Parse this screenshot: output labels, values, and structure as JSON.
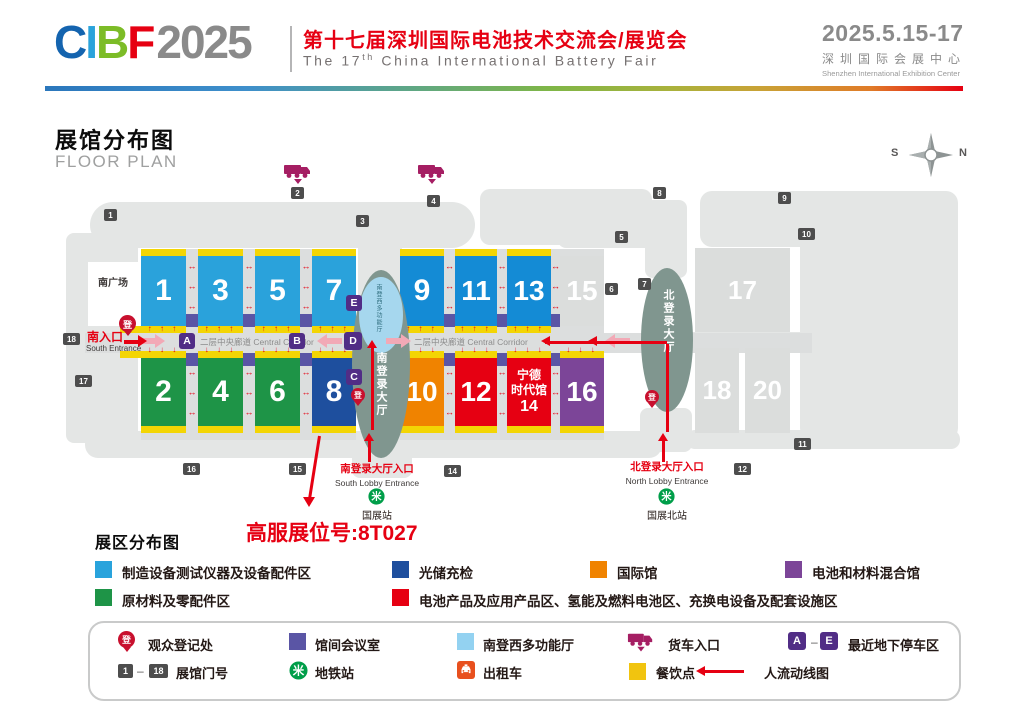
{
  "header": {
    "logo_letters": [
      {
        "ch": "C",
        "color": "#1464AF"
      },
      {
        "ch": "I",
        "color": "#2AA3DB"
      },
      {
        "ch": "B",
        "color": "#7CBC27"
      },
      {
        "ch": "F",
        "color": "#E60012"
      }
    ],
    "logo_year": "2025",
    "title_cn": "第十七届深圳国际电池技术交流会/展览会",
    "title_en_pre": "The 17",
    "title_en_sup": "th",
    "title_en_post": " China International Battery Fair",
    "date": "2025.5.15-17",
    "venue_cn": "深圳国际会展中心",
    "venue_en": "Shenzhen International Exhibition Center"
  },
  "plan": {
    "title_cn": "展馆分布图",
    "title_en": "FLOOR PLAN",
    "compass": {
      "west_label": "S",
      "east_label": "N"
    },
    "south_plaza": "南广场",
    "south_entrance_cn": "南入口",
    "south_entrance_en": "South Entrance",
    "corridor_label": "二层中央廊道 Central Corridor",
    "multifunction_vertical": "南登西多功能厅",
    "south_lobby_vertical": "南登录大厅",
    "north_lobby_vertical": "北登录大厅",
    "south_lobby_entrance_cn": "南登录大厅入口",
    "south_lobby_entrance_en": "South Lobby Entrance",
    "north_lobby_entrance_cn": "北登录大厅入口",
    "north_lobby_entrance_en": "North Lobby Entrance",
    "metro_south": "国展站",
    "metro_north": "国展北站",
    "metro_glyph": "米",
    "reg_glyph": "登",
    "booth_callout": "高服展位号:8T027",
    "halls": [
      {
        "n": "1",
        "x": 141,
        "y": 256,
        "w": 45,
        "h": 70,
        "c": "#2AA2DB",
        "s": true,
        "fs": 30
      },
      {
        "n": "3",
        "x": 198,
        "y": 256,
        "w": 45,
        "h": 70,
        "c": "#2AA2DB",
        "s": true,
        "fs": 30
      },
      {
        "n": "5",
        "x": 255,
        "y": 256,
        "w": 45,
        "h": 70,
        "c": "#2AA2DB",
        "s": true,
        "fs": 30
      },
      {
        "n": "7",
        "x": 312,
        "y": 256,
        "w": 44,
        "h": 70,
        "c": "#2AA2DB",
        "s": true,
        "fs": 30
      },
      {
        "n": "9",
        "x": 400,
        "y": 256,
        "w": 44,
        "h": 70,
        "c": "#148BD5",
        "s": true,
        "fs": 30
      },
      {
        "n": "11",
        "x": 455,
        "y": 256,
        "w": 42,
        "h": 70,
        "c": "#148BD5",
        "s": true,
        "fs": 28
      },
      {
        "n": "13",
        "x": 507,
        "y": 256,
        "w": 44,
        "h": 70,
        "c": "#148BD5",
        "s": true,
        "fs": 28
      },
      {
        "n": "15",
        "x": 560,
        "y": 256,
        "w": 44,
        "h": 70,
        "c": "#DBDDDC",
        "s": false,
        "fs": 28
      },
      {
        "n": "2",
        "x": 141,
        "y": 358,
        "w": 45,
        "h": 68,
        "c": "#1E9447",
        "s": true,
        "fs": 30
      },
      {
        "n": "4",
        "x": 198,
        "y": 358,
        "w": 45,
        "h": 68,
        "c": "#1E9447",
        "s": true,
        "fs": 30
      },
      {
        "n": "6",
        "x": 255,
        "y": 358,
        "w": 45,
        "h": 68,
        "c": "#1E9447",
        "s": true,
        "fs": 30
      },
      {
        "n": "8",
        "x": 312,
        "y": 358,
        "w": 44,
        "h": 68,
        "c": "#1E4F9E",
        "s": true,
        "fs": 30
      },
      {
        "n": "10",
        "x": 400,
        "y": 358,
        "w": 44,
        "h": 68,
        "c": "#F08300",
        "s": true,
        "fs": 28
      },
      {
        "n": "12",
        "x": 455,
        "y": 358,
        "w": 42,
        "h": 68,
        "c": "#E60012",
        "s": true,
        "fs": 28
      },
      {
        "n": "14",
        "x": 507,
        "y": 358,
        "w": 44,
        "h": 68,
        "c": "#E60012",
        "s": true,
        "fs": 15,
        "lines": [
          "宁德",
          "时代馆",
          "14"
        ]
      },
      {
        "n": "16",
        "x": 560,
        "y": 358,
        "w": 44,
        "h": 68,
        "c": "#7C4598",
        "s": true,
        "fs": 28
      },
      {
        "n": "17",
        "x": 695,
        "y": 248,
        "w": 95,
        "h": 84,
        "c": "#DBDDDC",
        "s": false,
        "fs": 26
      },
      {
        "n": "18",
        "x": 695,
        "y": 348,
        "w": 44,
        "h": 85,
        "c": "#DBDDDC",
        "s": false,
        "fs": 26
      },
      {
        "n": "20",
        "x": 745,
        "y": 348,
        "w": 45,
        "h": 85,
        "c": "#DBDDDC",
        "s": false,
        "fs": 26
      }
    ],
    "gates": [
      {
        "n": "1",
        "x": 104,
        "y": 209
      },
      {
        "n": "2",
        "x": 291,
        "y": 187
      },
      {
        "n": "3",
        "x": 356,
        "y": 215
      },
      {
        "n": "4",
        "x": 427,
        "y": 195
      },
      {
        "n": "5",
        "x": 615,
        "y": 231
      },
      {
        "n": "6",
        "x": 605,
        "y": 283
      },
      {
        "n": "7",
        "x": 638,
        "y": 278
      },
      {
        "n": "8",
        "x": 653,
        "y": 187
      },
      {
        "n": "9",
        "x": 778,
        "y": 192
      },
      {
        "n": "10",
        "x": 798,
        "y": 228
      },
      {
        "n": "11",
        "x": 794,
        "y": 438
      },
      {
        "n": "12",
        "x": 734,
        "y": 463
      },
      {
        "n": "14",
        "x": 444,
        "y": 465
      },
      {
        "n": "15",
        "x": 289,
        "y": 463
      },
      {
        "n": "16",
        "x": 183,
        "y": 463
      },
      {
        "n": "17",
        "x": 75,
        "y": 375
      },
      {
        "n": "18",
        "x": 63,
        "y": 333
      }
    ],
    "letters": [
      {
        "ch": "A",
        "x": 179,
        "y": 333
      },
      {
        "ch": "B",
        "x": 289,
        "y": 333
      },
      {
        "ch": "C",
        "x": 346,
        "y": 369
      },
      {
        "ch": "D",
        "x": 344,
        "y": 332
      },
      {
        "ch": "E",
        "x": 346,
        "y": 295
      }
    ]
  },
  "legend": {
    "title": "展区分布图",
    "items": [
      {
        "label": "制造设备测试仪器及设备配件区",
        "color": "#29A3DC"
      },
      {
        "label": "光储充检",
        "color": "#1E4F9E"
      },
      {
        "label": "国际馆",
        "color": "#F08300"
      },
      {
        "label": "电池和材料混合馆",
        "color": "#7C4598"
      },
      {
        "label": "原材料及零配件区",
        "color": "#1E9447"
      },
      {
        "label": "电池产品及应用产品区、氢能及燃料电池区、充换电设备及配套设施区",
        "color": "#E60012"
      }
    ]
  },
  "facilities": {
    "items": [
      {
        "icon": "reg-pin",
        "label": "观众登记处"
      },
      {
        "icon": "meeting-square",
        "label": "馆间会议室",
        "color": "#5A55A5"
      },
      {
        "icon": "multifunction-square",
        "label": "南登西多功能厅",
        "color": "#93D2F1"
      },
      {
        "icon": "truck",
        "label": "货车入口",
        "color": "#A51E63"
      },
      {
        "icon": "parking-range",
        "label": "最近地下停车区",
        "from": "A",
        "to": "E",
        "color": "#512D86"
      },
      {
        "icon": "gate-range",
        "label": "展馆门号",
        "from": "1",
        "to": "18"
      },
      {
        "icon": "metro",
        "label": "地铁站",
        "color": "#009E49"
      },
      {
        "icon": "taxi",
        "label": "出租车",
        "color": "#E8501E"
      },
      {
        "icon": "food-square",
        "label": "餐饮点",
        "color": "#F1C40F"
      },
      {
        "icon": "flow-arrow",
        "label": "人流动线图",
        "color": "#E60012"
      }
    ]
  },
  "colors": {
    "yellow_strip": "#F3D504",
    "corridor": "#DCDEDE",
    "map_shape": "#E4E6E5",
    "lobby": "#80968F",
    "multifunction": "#A6D7EE",
    "letter_chip": "#512D86",
    "meeting_room": "#5A55A5",
    "gate_chip": "#4D4D4D",
    "flow_red": "#E60012",
    "pink_arrow": "#F2A9B6",
    "truck": "#A51E63",
    "metro": "#009E49",
    "taxi": "#E8501E",
    "reg_pin": "#C8102E"
  }
}
